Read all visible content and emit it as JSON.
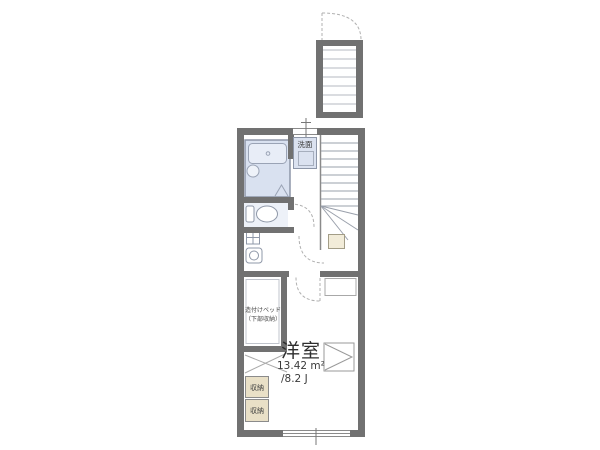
{
  "labels": {
    "washstand": "洗面",
    "built_in_bed_line1": "造付けベッド",
    "built_in_bed_line2": "（下部収納）",
    "room_name": "洋室",
    "room_area": "13.42 m²",
    "room_tatami": "/8.2 J",
    "storage_top": "収納",
    "storage_bottom": "収納"
  },
  "rooms": {
    "bathroom": "unit-bath with bathtub and round basin",
    "toilet": "toilet room",
    "washroom": "washbasin and laundry area",
    "bedroom": "western-style room 13.42 m² / 8.2 J",
    "stairs": "staircase with winder treads and exterior landing"
  },
  "colors": {
    "wall": "#717171",
    "bath_fill": "#d9e1f0",
    "washstand_fill": "#dbe2f0",
    "toilet_room_fill": "#edf1f8",
    "storage_fill": "#e9e0c7",
    "entry_box_fill": "#f2ecd9",
    "thin_line": "#a7adb8",
    "text": "#333333"
  }
}
